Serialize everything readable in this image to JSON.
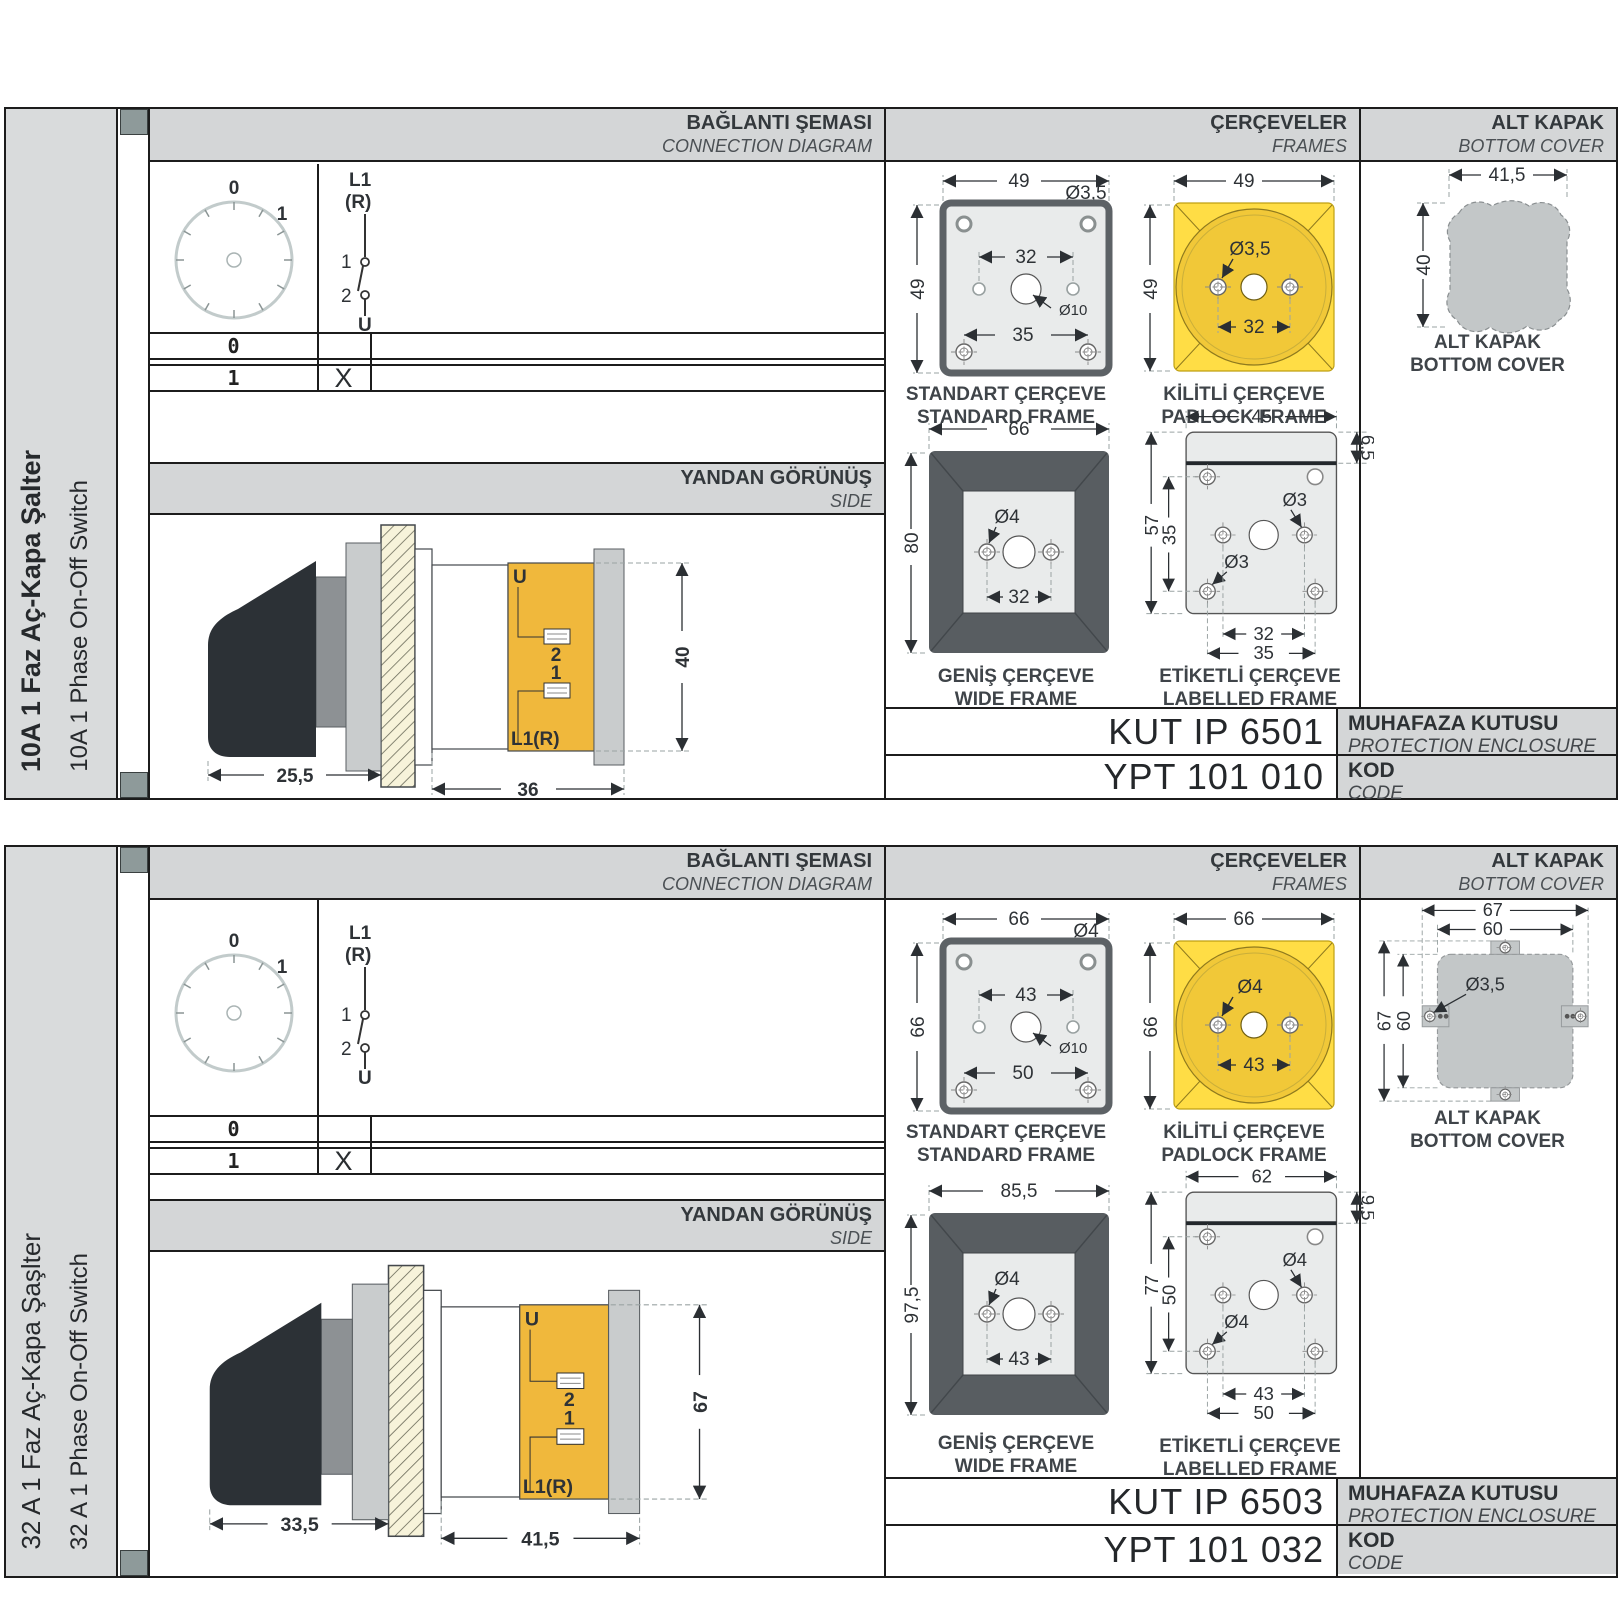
{
  "common": {
    "headers": {
      "connection_tr": "BAĞLANTI ŞEMASI",
      "connection_en": "CONNECTION DIAGRAM",
      "frames_tr": "ÇERÇEVELER",
      "frames_en": "FRAMES",
      "cover_tr": "ALT KAPAK",
      "cover_en": "BOTTOM COVER",
      "side_tr": "YANDAN GÖRÜNÜŞ",
      "side_en": "SIDE"
    },
    "dial": {
      "pos_top": "0",
      "pos_right": "1"
    },
    "schematic": {
      "in1": "L1",
      "in2": "(R)",
      "c1": "1",
      "c2": "2",
      "out": "U"
    },
    "table": {
      "row0": "0",
      "row0_mark": "",
      "row1": "1",
      "row1_mark": "X"
    },
    "frame_captions": {
      "standard_tr": "STANDART ÇERÇEVE",
      "standard_en": "STANDARD FRAME",
      "padlock_tr": "KİLİTLİ ÇERÇEVE",
      "padlock_en": "PADLOCK FRAME",
      "wide_tr": "GENİŞ ÇERÇEVE",
      "wide_en": "WIDE FRAME",
      "labelled_tr": "ETİKETLİ ÇERÇEVE",
      "labelled_en": "LABELLED FRAME"
    },
    "cover_caption": {
      "tr": "ALT KAPAK",
      "en": "BOTTOM COVER"
    },
    "enclosure_label": {
      "tr": "MUHAFAZA KUTUSU",
      "en": "PROTECTION ENCLOSURE"
    },
    "code_label": {
      "tr": "KOD",
      "en": "CODE"
    },
    "side_labels": {
      "u": "U",
      "t2": "2",
      "t1": "1",
      "l1": "L1(R)"
    },
    "colors": {
      "panel_gray": "#d4d6d7",
      "frame_yellow": "#FFDD45",
      "dial_yellow": "#F1C838",
      "body_orange": "#F0B83C",
      "cover_gray": "#c3c7c8"
    }
  },
  "sections": [
    {
      "sidebar_tr": "10A 1 Faz Aç-Kapa Şalter",
      "sidebar_en": "10A 1 Phase On-Off Switch",
      "side_view": {
        "dim_a": "25,5",
        "dim_b": "36",
        "dim_h": "40"
      },
      "standard": {
        "w": "49",
        "h": "49",
        "hole": "Ø3,5",
        "pitch": "32",
        "center": "Ø10",
        "pitch2": "35"
      },
      "padlock": {
        "w": "49",
        "h": "49",
        "hole": "Ø3,5",
        "pitch": "32"
      },
      "wide": {
        "w": "66",
        "h": "80",
        "hole": "Ø4",
        "pitch": "32"
      },
      "labelled": {
        "w": "45",
        "band": "6,5",
        "h": "57",
        "h2": "35",
        "hole1": "Ø3",
        "hole2": "Ø3",
        "pitch": "32",
        "pitch2": "35"
      },
      "cover": {
        "w": "41,5",
        "h": "40"
      },
      "enclosure_code": "KUT IP 6501",
      "order_code": "YPT 101 010"
    },
    {
      "sidebar_tr": "32 A 1 Faz Aç-Kapa Şaşlter",
      "sidebar_en": "32 A 1 Phase On-Off Switch",
      "side_view": {
        "dim_a": "33,5",
        "dim_b": "41,5",
        "dim_h": "67"
      },
      "standard": {
        "w": "66",
        "h": "66",
        "hole": "Ø4",
        "pitch": "43",
        "center": "Ø10",
        "pitch2": "50"
      },
      "padlock": {
        "w": "66",
        "h": "66",
        "hole": "Ø4",
        "pitch": "43"
      },
      "wide": {
        "w": "85,5",
        "h": "97,5",
        "hole": "Ø4",
        "pitch": "43"
      },
      "labelled": {
        "w": "62",
        "band": "9,5",
        "h": "77",
        "h2": "50",
        "hole1": "Ø4",
        "hole2": "Ø4",
        "pitch": "43",
        "pitch2": "50"
      },
      "cover": {
        "w1": "67",
        "w2": "60",
        "h1": "67",
        "h2": "60",
        "hole": "Ø3,5"
      },
      "enclosure_code": "KUT IP 6503",
      "order_code": "YPT 101 032"
    }
  ]
}
